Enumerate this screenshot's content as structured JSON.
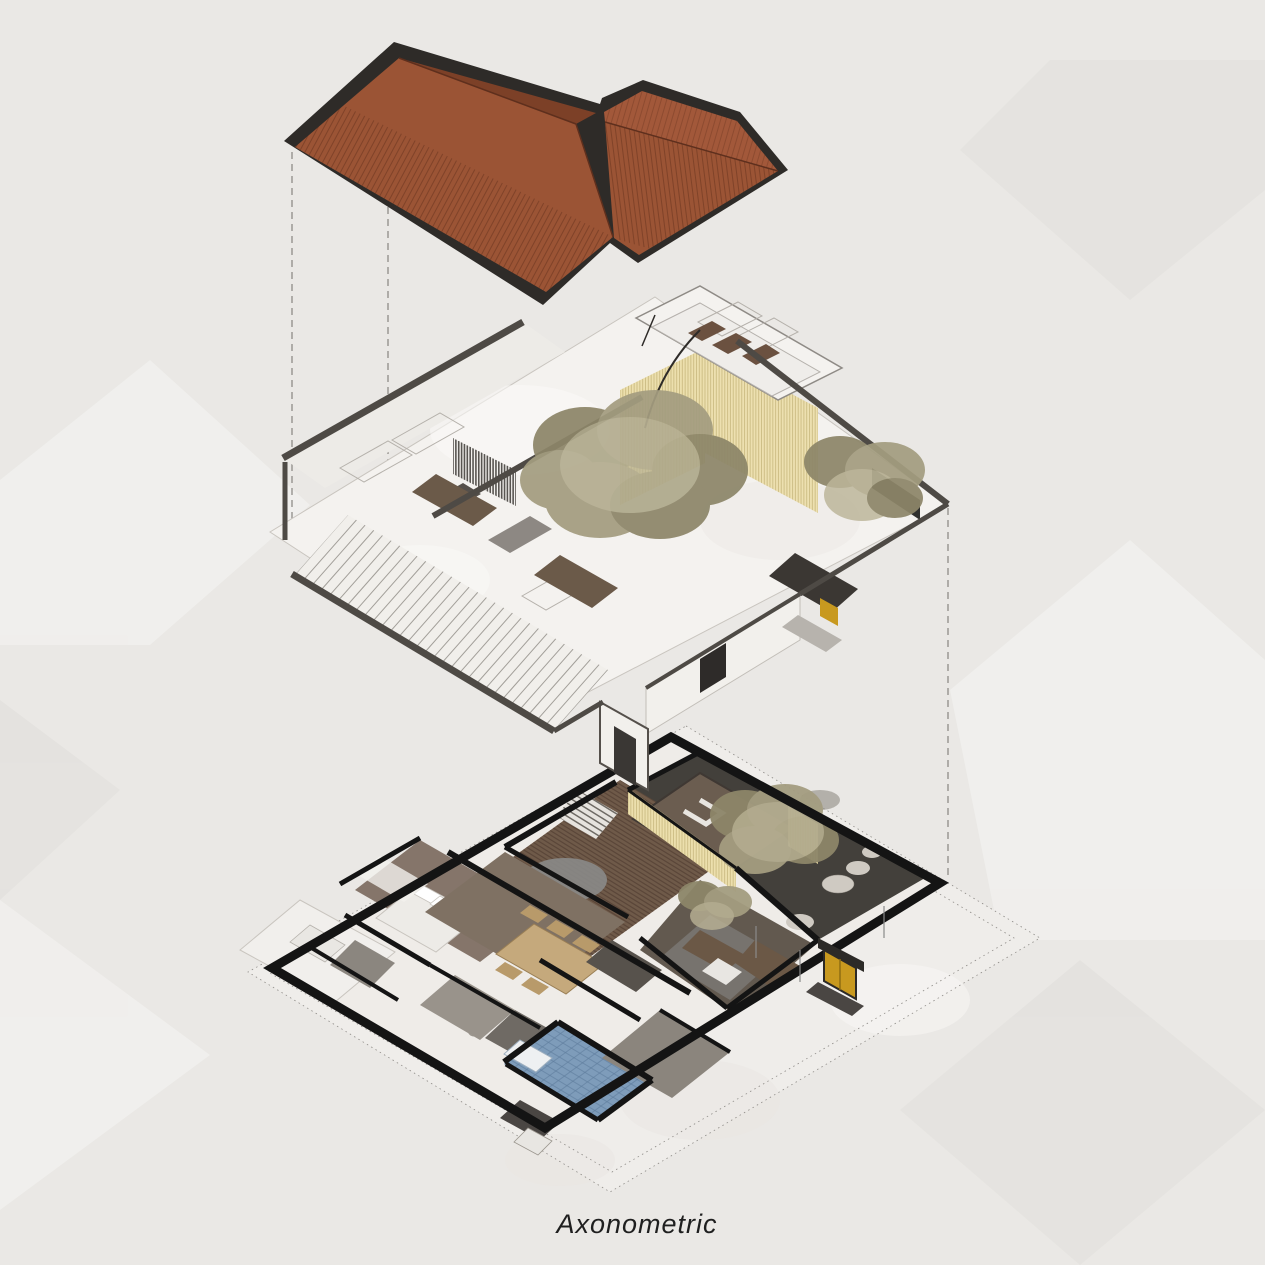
{
  "title": {
    "label": "Axonometric"
  },
  "colors": {
    "background": "#eae8e5",
    "paper_shape_light": "#f2f1ef",
    "paper_shape_dark": "#e3e1de",
    "roof_tile": "#9b5435",
    "roof_tile_dark": "#7c4027",
    "roof_tile_light": "#a2583a",
    "roof_stripe": "#5f2f1c",
    "roof_edge": "#2e2b28",
    "wall_cap": "#4e4a45",
    "wall_white": "#f4f2ef",
    "line_gray": "#b5b1ab",
    "plan_wall": "#141414",
    "floor_light": "#efece8",
    "stone_margin": "#efedea",
    "deck_wood": "#6f5a49",
    "deck_stripe": "#544135",
    "inner_roof": "#6b5d50",
    "courtyard": "#43403b",
    "rock": "#cfcac2",
    "tree_olive": "#a49d80",
    "tree_olive_dark": "#8d8669",
    "tree_olive_light": "#b8b194",
    "slat_yellow": "#ecdfad",
    "slat_yellow_line": "#cdbd85",
    "tile_blue": "#7e9cba",
    "tile_blue_line": "#5f7d9d",
    "door_yellow": "#c8991f",
    "table_wood": "#c5a97c",
    "sofa_brown": "#6b5846",
    "rug_gray": "#77736e",
    "dashed_line": "#8f8c88",
    "text": "#1f1f1f"
  }
}
